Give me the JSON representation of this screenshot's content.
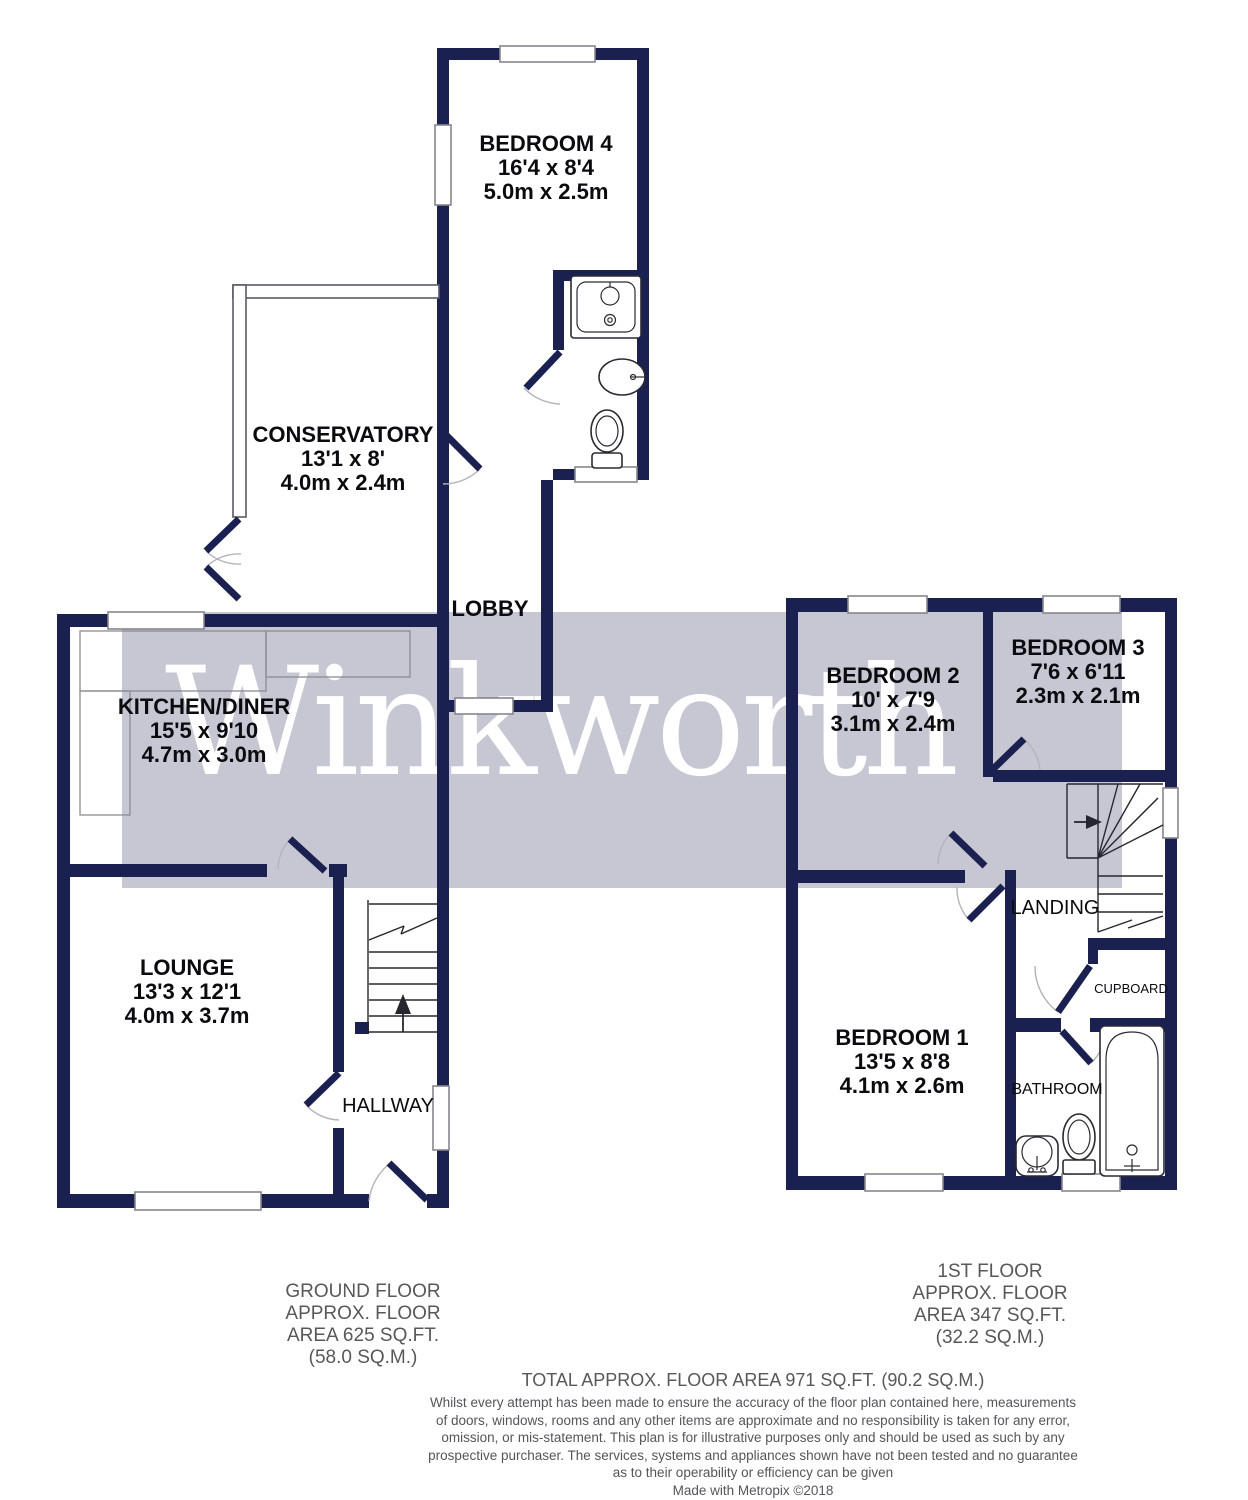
{
  "watermark": {
    "text": "Winkworth"
  },
  "colors": {
    "wall": "#1a2050",
    "watermark_band": "#c7c7d3",
    "watermark_text": "#ffffff",
    "footer_text": "#57585a"
  },
  "ground_floor": {
    "rooms": {
      "bedroom4": {
        "name": "BEDROOM 4",
        "imperial": "16'4 x 8'4",
        "metric": "5.0m x 2.5m"
      },
      "conservatory": {
        "name": "CONSERVATORY",
        "imperial": "13'1 x 8'",
        "metric": "4.0m x 2.4m"
      },
      "kitchen_diner": {
        "name": "KITCHEN/DINER",
        "imperial": "15'5 x 9'10",
        "metric": "4.7m x 3.0m"
      },
      "lounge": {
        "name": "LOUNGE",
        "imperial": "13'3 x 12'1",
        "metric": "4.0m x 3.7m"
      },
      "lobby": {
        "name": "LOBBY"
      },
      "hallway": {
        "name": "HALLWAY"
      }
    },
    "area_note": {
      "line1": "GROUND FLOOR",
      "line2": "APPROX. FLOOR",
      "line3": "AREA 625 SQ.FT.",
      "line4": "(58.0 SQ.M.)"
    }
  },
  "first_floor": {
    "rooms": {
      "bedroom1": {
        "name": "BEDROOM 1",
        "imperial": "13'5 x 8'8",
        "metric": "4.1m x 2.6m"
      },
      "bedroom2": {
        "name": "BEDROOM 2",
        "imperial": "10' x 7'9",
        "metric": "3.1m x 2.4m"
      },
      "bedroom3": {
        "name": "BEDROOM 3",
        "imperial": "7'6 x 6'11",
        "metric": "2.3m x 2.1m"
      },
      "landing": {
        "name": "LANDING"
      },
      "cupboard": {
        "name": "CUPBOARD"
      },
      "bathroom": {
        "name": "BATHROOM"
      }
    },
    "area_note": {
      "line1": "1ST FLOOR",
      "line2": "APPROX. FLOOR",
      "line3": "AREA 347 SQ.FT.",
      "line4": "(32.2 SQ.M.)"
    }
  },
  "footer": {
    "total": "TOTAL APPROX. FLOOR AREA 971 SQ.FT. (90.2 SQ.M.)",
    "disclaimer": [
      "Whilst every attempt has been made to ensure the accuracy of the floor plan contained here, measurements",
      "of doors, windows, rooms and any other items are approximate and no responsibility is taken for any error,",
      "omission, or mis-statement. This plan is for illustrative purposes only and should be used as such by any",
      "prospective purchaser. The services, systems and appliances shown have not been tested and no guarantee",
      "as to their operability or efficiency can be given"
    ],
    "credit": "Made with Metropix ©2018"
  }
}
